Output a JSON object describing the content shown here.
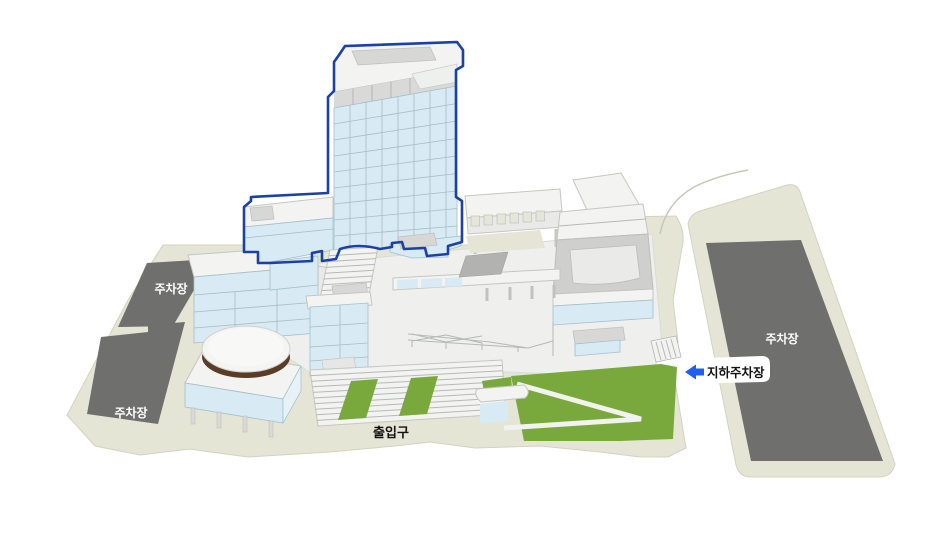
{
  "labels": {
    "parking_left_top": "주차장",
    "parking_left_bottom": "주차장",
    "parking_right": "주차장",
    "entrance": "출입구",
    "underground_parking": "지하주차장"
  },
  "icons": {
    "underground_parking_arrow": "left-arrow-icon"
  },
  "colors": {
    "ground": "#e4e5d5",
    "ground_edge": "#d2d4c0",
    "parking_lot": "#6f6f6e",
    "building_white": "#f3f4f2",
    "building_face": "#e9eae8",
    "building_stroke": "#c4c6c2",
    "panel_gray": "#d7d8d6",
    "courtyard_gray": "#cfd0ce",
    "glass_blue": "#d8eaf3",
    "glass_stroke": "#a2c0cd",
    "grid_line": "#a9bcc3",
    "highlight_outline": "#1c41a5",
    "lawn_green": "#79a83c",
    "path_white": "#f2f3ee",
    "dome_ring_brown": "#5b3c26",
    "arrow_blue": "#1e5ef0",
    "label_dark": "#121212",
    "label_light": "#ffffff"
  }
}
